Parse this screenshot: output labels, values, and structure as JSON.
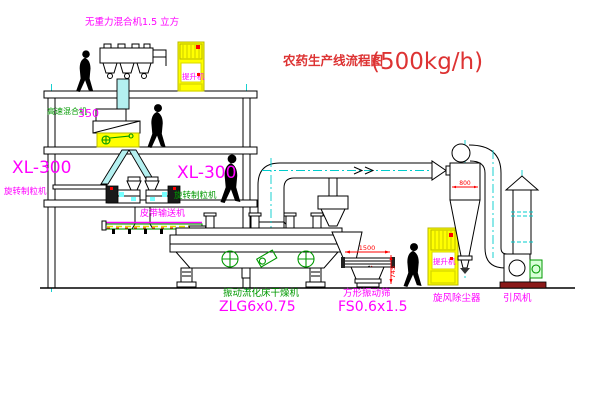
{
  "title": {
    "name": "农药生产线流程图",
    "capacity": "(500kg/h)"
  },
  "labels": {
    "top_mixer": "无重力混合机1.5 立方",
    "high_speed_mixer": "高速混合机",
    "high_speed_mixer_model": "350",
    "granulator_model_left": "XL-300",
    "granulator_name_left": "旋转制粒机",
    "granulator_model_right": "XL-300",
    "granulator_name_right": "旋转制粒机",
    "belt_conveyor": "皮带输送机",
    "dryer_name": "振动流化床干燥机",
    "dryer_model": "ZLG6x0.75",
    "sieve_name": "方形振动筛",
    "sieve_model": "FS0.6x1.5",
    "cyclone": "旋风除尘器",
    "fan": "引风机",
    "elevator_top": "提升机",
    "elevator_right": "提升机"
  },
  "dimensions": {
    "sieve_length": "1500",
    "sieve_height": "745",
    "cyclone_inlet": "800"
  },
  "colors": {
    "magenta": "#ff00ff",
    "green": "#009900",
    "title_red": "#dd3333",
    "dim_red": "#ff0000",
    "yellow": "#ffff00",
    "cyan": "#00cccc",
    "black": "#000000",
    "base_red": "#8b1a1a"
  }
}
